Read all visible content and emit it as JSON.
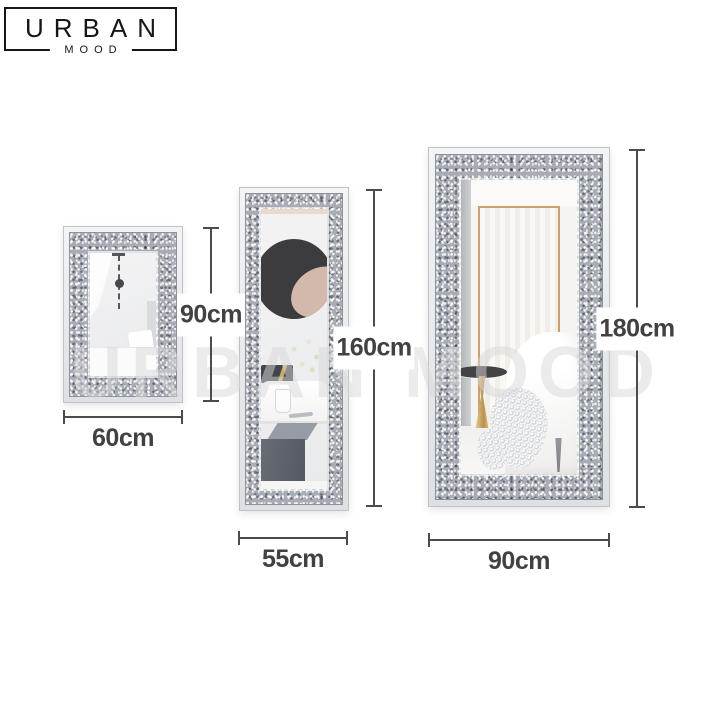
{
  "brand": {
    "name": "URBAN",
    "sub": "MOOD"
  },
  "watermark": "URBAN MOOD",
  "mirrors": [
    {
      "name": "small-wall-mirror",
      "width_label": "60cm",
      "height_label": "90cm"
    },
    {
      "name": "medium-full-length-mirror",
      "width_label": "55cm",
      "height_label": "160cm"
    },
    {
      "name": "large-full-length-mirror",
      "width_label": "90cm",
      "height_label": "180cm"
    }
  ],
  "colors": {
    "background": "#ffffff",
    "dimension_line": "#4c4c4c",
    "dimension_text": "#414141",
    "logo_text": "#161616",
    "frame_band_gray": "#a8adb5",
    "frame_bevel": "#e9ebee",
    "gold_accent": "#cb9f6f",
    "wall_art_dark": "#3c3c3e",
    "wall_art_blush": "#d3b9ab",
    "watermark_gray": "#d7d7d9"
  }
}
